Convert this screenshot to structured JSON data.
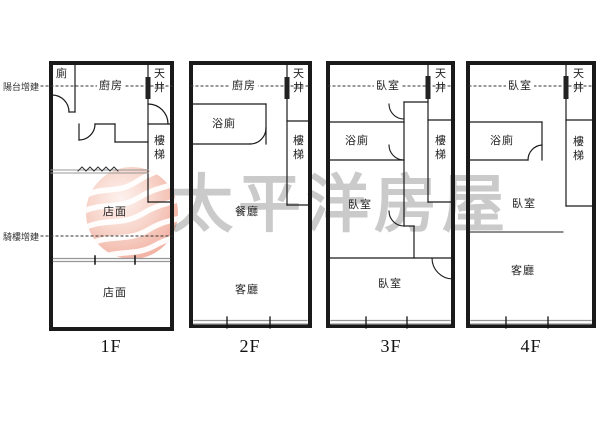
{
  "watermark": {
    "text": "太平洋房屋",
    "logo_name": "pacific-realty-logo"
  },
  "margin_labels": {
    "balcony_addition": "陽台增建",
    "arcade_addition": "騎樓增建"
  },
  "floors": [
    {
      "label": "1F",
      "rooms": {
        "toilet": "廁",
        "kitchen": "廚房",
        "lightwell": "天井",
        "stairs": "樓梯",
        "store_upper": "店面",
        "store_lower": "店面"
      }
    },
    {
      "label": "2F",
      "rooms": {
        "kitchen": "廚房",
        "lightwell": "天井",
        "bath": "浴廁",
        "stairs": "樓梯",
        "dining": "餐廳",
        "living": "客廳"
      }
    },
    {
      "label": "3F",
      "rooms": {
        "bed_top": "臥室",
        "lightwell": "天井",
        "bath": "浴廁",
        "stairs": "樓梯",
        "bed_mid": "臥室",
        "bed_bottom": "臥室"
      }
    },
    {
      "label": "4F",
      "rooms": {
        "bed_top": "臥室",
        "lightwell": "天井",
        "bath": "浴廁",
        "stairs": "樓梯",
        "bed_mid": "臥室",
        "living": "客廳"
      }
    }
  ],
  "colors": {
    "wall": "#1a1a1a",
    "thin_line": "#3a3a3a",
    "gray_wall": "#979797",
    "watermark_text": "#9e9e9e",
    "logo_pink_edge": "#efa392",
    "logo_pink_center": "#fdf1ed"
  }
}
